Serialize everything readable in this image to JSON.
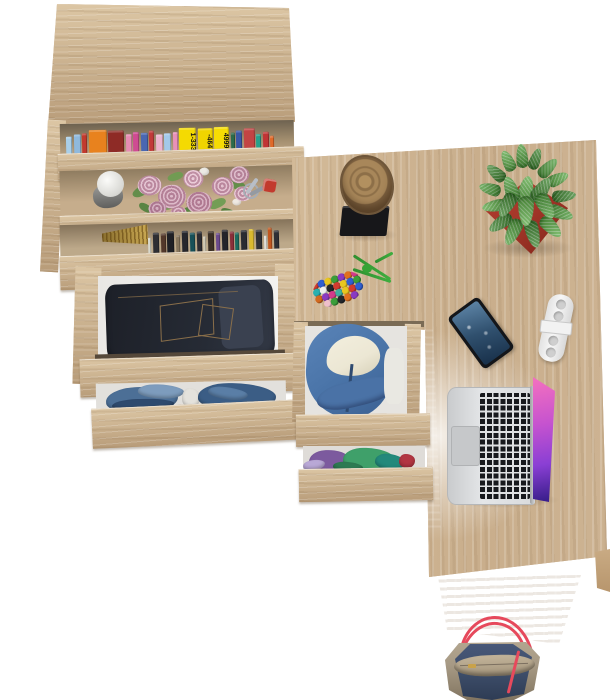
{
  "scene": {
    "type": "furniture-product-photo",
    "subject": "L-shaped oak desk with bookcase, open drawers and desk accessories, top view on white background",
    "background": "white"
  },
  "palette": {
    "bg": "#ffffff",
    "oak": "#cdb394",
    "oak_light": "#dcc6a4",
    "oak_dark": "#b89c79",
    "oak_panel": "#cfb28b",
    "shelf_shadow": "#6e6250",
    "jeans": "#262b35",
    "jeans_dark": "#1d2028",
    "jeans_stitch": "#8a6f4a",
    "hoodie": "#4a74a8",
    "hoodie_lining": "#ece7d4",
    "log": "#a8875a",
    "log_dark": "#6e563a",
    "base_black": "#17171a",
    "pot": "#a5372a",
    "plant": "#4f9e3c",
    "cord": "#3fae3f",
    "phone": "#14161a",
    "phone_screen": "#30506e",
    "gadget": "#f7f7f7",
    "laptop_silver": "#d9dbdd",
    "key_black": "#17191d",
    "bag_taupe": "#a79a85",
    "bag_navy": "#3d4d69",
    "bag_red": "#e6495c"
  },
  "objects": [
    {
      "name": "bookcase",
      "desc": "tall oak bookcase, two shelves of books, decor shelf, two open drawers"
    },
    {
      "name": "desk",
      "desc": "oak desk surface with log decor, succulent plant, keychain, phone, white gadget, laptop"
    },
    {
      "name": "pedestal",
      "desc": "under-desk drawer unit with blue hoodie and folded clothes"
    },
    {
      "name": "bag",
      "desc": "navy and taupe tote bag with red handles below desk"
    }
  ],
  "bookshelf": {
    "top_books": [
      {
        "c": "#a9cfe9",
        "w": 6,
        "h": 22
      },
      {
        "c": "#8fb9dd",
        "w": 7,
        "h": 24
      },
      {
        "c": "#c23a2e",
        "w": 5,
        "h": 25
      },
      {
        "c": "#e8821e",
        "w": 18,
        "h": 28
      },
      {
        "c": "#8e2b26",
        "w": 16,
        "h": 27
      },
      {
        "c": "#e78cb4",
        "w": 6,
        "h": 23
      },
      {
        "c": "#cf4b92",
        "w": 6,
        "h": 25
      },
      {
        "c": "#4a67b1",
        "w": 7,
        "h": 24
      },
      {
        "c": "#c23a3a",
        "w": 5,
        "h": 26
      },
      {
        "c": "#edb5cf",
        "w": 7,
        "h": 22
      },
      {
        "c": "#a3c9e9",
        "w": 7,
        "h": 23
      },
      {
        "c": "#e891b9",
        "w": 5,
        "h": 24
      },
      {
        "c": "#f4da02",
        "w": 17,
        "h": 28,
        "label": "1-333"
      },
      {
        "c": "#f0d400",
        "w": 15,
        "h": 27,
        "label": "-464"
      },
      {
        "c": "#f6dc04",
        "w": 15,
        "h": 28,
        "label": "4999"
      },
      {
        "c": "#2c6b4b",
        "w": 4,
        "h": 22
      },
      {
        "c": "#3a57a5",
        "w": 6,
        "h": 24
      },
      {
        "c": "#c24444",
        "w": 11,
        "h": 26
      },
      {
        "c": "#27a08c",
        "w": 5,
        "h": 20
      },
      {
        "c": "#c03535",
        "w": 6,
        "h": 22
      },
      {
        "c": "#e06a2a",
        "w": 4,
        "h": 18
      }
    ],
    "dark_books": [
      {
        "c": "#d8d8cc",
        "w": 3,
        "h": 18
      },
      {
        "c": "#2e2e33",
        "w": 6,
        "h": 23
      },
      {
        "c": "#53382a",
        "w": 5,
        "h": 22
      },
      {
        "c": "#1f2025",
        "w": 7,
        "h": 24
      },
      {
        "c": "#86755c",
        "w": 4,
        "h": 20
      },
      {
        "c": "#26272d",
        "w": 6,
        "h": 24
      },
      {
        "c": "#175058",
        "w": 5,
        "h": 22
      },
      {
        "c": "#2d2d33",
        "w": 5,
        "h": 23
      },
      {
        "c": "#d0c9b4",
        "w": 3,
        "h": 18
      },
      {
        "c": "#3b2f25",
        "w": 6,
        "h": 23
      },
      {
        "c": "#6b4a8c",
        "w": 4,
        "h": 21
      },
      {
        "c": "#23242a",
        "w": 6,
        "h": 24
      },
      {
        "c": "#8a2f3a",
        "w": 4,
        "h": 22
      },
      {
        "c": "#1c6b60",
        "w": 4,
        "h": 21
      },
      {
        "c": "#2a2b31",
        "w": 6,
        "h": 23
      },
      {
        "c": "#d9b92f",
        "w": 5,
        "h": 24
      },
      {
        "c": "#2f3036",
        "w": 6,
        "h": 23
      },
      {
        "c": "#e0dfda",
        "w": 3,
        "h": 17
      },
      {
        "c": "#c2571f",
        "w": 4,
        "h": 25
      },
      {
        "c": "#2e2f35",
        "w": 5,
        "h": 22
      }
    ],
    "bouquet": [
      {
        "cls": "leaf",
        "x": 8,
        "y": 18,
        "w": 20,
        "h": 10,
        "c": "#5f8c48",
        "r": -20
      },
      {
        "cls": "leaf",
        "x": 30,
        "y": 34,
        "w": 18,
        "h": 9,
        "c": "#6f9c52",
        "r": 15
      },
      {
        "cls": "leaf",
        "x": 58,
        "y": 40,
        "w": 20,
        "h": 10,
        "c": "#54823f",
        "r": 5
      },
      {
        "cls": "leaf",
        "x": 84,
        "y": 34,
        "w": 18,
        "h": 9,
        "c": "#6f9c52",
        "r": -15
      },
      {
        "cls": "leaf",
        "x": 104,
        "y": 16,
        "w": 18,
        "h": 9,
        "c": "#5f8c48",
        "r": 25
      },
      {
        "cls": "leaf",
        "x": 44,
        "y": 6,
        "w": 16,
        "h": 8,
        "c": "#6f9c52",
        "r": -10
      },
      {
        "cls": "leaf",
        "x": 96,
        "y": 44,
        "w": 16,
        "h": 8,
        "c": "#4f7c3b",
        "r": 30
      },
      {
        "cls": "leaf",
        "x": 14,
        "y": 36,
        "w": 14,
        "h": 8,
        "c": "#54823f",
        "r": 40
      },
      {
        "cls": "bud",
        "x": 76,
        "y": 2,
        "w": 10,
        "h": 8,
        "c": "#eceae4"
      },
      {
        "cls": "bud",
        "x": 108,
        "y": 34,
        "w": 9,
        "h": 7,
        "c": "#efe9e2"
      },
      {
        "cls": "bud",
        "x": 36,
        "y": 46,
        "w": 9,
        "h": 7,
        "c": "#e8e2d8"
      },
      {
        "cls": "rose",
        "x": 14,
        "y": 8,
        "w": 24,
        "h": 20,
        "c": "#d9aabe"
      },
      {
        "cls": "rose",
        "x": 34,
        "y": 18,
        "w": 28,
        "h": 24,
        "c": "#cf9cb2"
      },
      {
        "cls": "rose",
        "x": 60,
        "y": 4,
        "w": 20,
        "h": 18,
        "c": "#e2b6c8"
      },
      {
        "cls": "rose",
        "x": 62,
        "y": 26,
        "w": 26,
        "h": 22,
        "c": "#c993ab"
      },
      {
        "cls": "rose",
        "x": 88,
        "y": 12,
        "w": 22,
        "h": 19,
        "c": "#d9a8bc"
      },
      {
        "cls": "rose",
        "x": 106,
        "y": 2,
        "w": 20,
        "h": 17,
        "c": "#cf9fb4"
      },
      {
        "cls": "rose",
        "x": 110,
        "y": 22,
        "w": 18,
        "h": 15,
        "c": "#dcaec0"
      },
      {
        "cls": "rose",
        "x": 24,
        "y": 34,
        "w": 18,
        "h": 15,
        "c": "#c28da6"
      },
      {
        "cls": "rose",
        "x": 46,
        "y": 40,
        "w": 16,
        "h": 13,
        "c": "#d4a2b6"
      }
    ],
    "drawer_clothes": [
      {
        "cls": "cloth",
        "x": 10,
        "y": 4,
        "w": 72,
        "h": 26,
        "c": "#4c6f96",
        "r": -2
      },
      {
        "cls": "cloth",
        "x": 16,
        "y": 16,
        "w": 62,
        "h": 12,
        "c": "#2e4a6e",
        "r": -1
      },
      {
        "cls": "cloth",
        "x": 42,
        "y": 2,
        "w": 46,
        "h": 14,
        "c": "#7d9cbd",
        "r": 3
      },
      {
        "cls": "cloth",
        "x": 86,
        "y": 6,
        "w": 18,
        "h": 20,
        "c": "#e4e2dc",
        "r": 0
      },
      {
        "cls": "cloth",
        "x": 102,
        "y": 2,
        "w": 78,
        "h": 28,
        "c": "#3b5d85",
        "r": 2
      },
      {
        "cls": "cloth",
        "x": 112,
        "y": 6,
        "w": 40,
        "h": 12,
        "c": "#5a7ea6",
        "r": 8
      }
    ]
  },
  "desk": {
    "plant_leaves": [
      {
        "cls": "plant-leaf",
        "x": 38,
        "y": 2,
        "w": 12,
        "h": 24,
        "c": "#4f9e3c",
        "r": -5
      },
      {
        "cls": "plant-leaf",
        "x": 52,
        "y": 6,
        "w": 11,
        "h": 22,
        "c": "#3f8630",
        "r": 20
      },
      {
        "cls": "plant-leaf",
        "x": 24,
        "y": 8,
        "w": 12,
        "h": 22,
        "c": "#5cab46",
        "r": -25
      },
      {
        "cls": "plant-leaf",
        "x": 64,
        "y": 14,
        "w": 12,
        "h": 24,
        "c": "#4f9e3c",
        "r": 45
      },
      {
        "cls": "plant-leaf",
        "x": 12,
        "y": 20,
        "w": 12,
        "h": 22,
        "c": "#3f8630",
        "r": -50
      },
      {
        "cls": "plant-leaf",
        "x": 74,
        "y": 26,
        "w": 12,
        "h": 22,
        "c": "#5cab46",
        "r": 65
      },
      {
        "cls": "plant-leaf",
        "x": 6,
        "y": 36,
        "w": 12,
        "h": 22,
        "c": "#4f9e3c",
        "r": -75
      },
      {
        "cls": "plant-leaf",
        "x": 80,
        "y": 42,
        "w": 12,
        "h": 24,
        "c": "#3f8630",
        "r": 85
      },
      {
        "cls": "plant-leaf",
        "x": 10,
        "y": 52,
        "w": 12,
        "h": 24,
        "c": "#5cab46",
        "r": -100
      },
      {
        "cls": "plant-leaf",
        "x": 76,
        "y": 58,
        "w": 13,
        "h": 26,
        "c": "#4f9e3c",
        "r": 110
      },
      {
        "cls": "plant-leaf",
        "x": 16,
        "y": 68,
        "w": 13,
        "h": 26,
        "c": "#3f8630",
        "r": -125
      },
      {
        "cls": "plant-leaf",
        "x": 66,
        "y": 72,
        "w": 14,
        "h": 26,
        "c": "#5cab46",
        "r": 135
      },
      {
        "cls": "plant-leaf",
        "x": 28,
        "y": 76,
        "w": 14,
        "h": 28,
        "c": "#4f9e3c",
        "r": -155
      },
      {
        "cls": "plant-leaf",
        "x": 48,
        "y": 78,
        "w": 14,
        "h": 28,
        "c": "#3f8630",
        "r": 165
      },
      {
        "cls": "plant-leaf",
        "x": 40,
        "y": 34,
        "w": 16,
        "h": 30,
        "c": "#5cab46",
        "r": 10
      },
      {
        "cls": "plant-leaf",
        "x": 26,
        "y": 34,
        "w": 14,
        "h": 26,
        "c": "#4f9e3c",
        "r": -20
      },
      {
        "cls": "plant-leaf",
        "x": 56,
        "y": 34,
        "w": 15,
        "h": 28,
        "c": "#3f8630",
        "r": 35
      },
      {
        "cls": "plant-leaf",
        "x": 40,
        "y": 54,
        "w": 16,
        "h": 30,
        "c": "#5cab46",
        "r": 180
      },
      {
        "cls": "plant-leaf",
        "x": 22,
        "y": 50,
        "w": 14,
        "h": 26,
        "c": "#3f8630",
        "r": -150
      },
      {
        "cls": "plant-leaf",
        "x": 60,
        "y": 50,
        "w": 15,
        "h": 28,
        "c": "#4f9e3c",
        "r": 150
      }
    ],
    "bead_colors": [
      "#d23b2f",
      "#2f5fd2",
      "#e8c61f",
      "#3a9e3a",
      "#8a3ac2",
      "#e0701f",
      "#d23b8a",
      "#29b0b0",
      "#efefef",
      "#23262b",
      "#d23b2f",
      "#e8c61f",
      "#2f5fd2",
      "#3a9e3a",
      "#d2691f",
      "#8a3ac2",
      "#d23b8a",
      "#3fae9e",
      "#e8c61f",
      "#d23b2f",
      "#2f5fd2",
      "#efc0cb",
      "#3a9e3a",
      "#23262b",
      "#e0701f",
      "#8a3ac2"
    ]
  },
  "pedestal": {
    "drawer_clothes": [
      {
        "cls": "cloth",
        "x": 6,
        "y": 4,
        "w": 40,
        "h": 22,
        "c": "#7c5a9e",
        "r": -3
      },
      {
        "cls": "cloth",
        "x": 40,
        "y": 2,
        "w": 52,
        "h": 24,
        "c": "#3fa06a",
        "r": 2
      },
      {
        "cls": "cloth",
        "x": 72,
        "y": 8,
        "w": 30,
        "h": 16,
        "c": "#23897b",
        "r": 6
      },
      {
        "cls": "cloth",
        "x": 96,
        "y": 8,
        "w": 16,
        "h": 14,
        "c": "#b23642",
        "r": 0
      },
      {
        "cls": "cloth",
        "x": 0,
        "y": 14,
        "w": 22,
        "h": 10,
        "c": "#b9a8d6",
        "r": -8
      },
      {
        "cls": "cloth",
        "x": 30,
        "y": 16,
        "w": 30,
        "h": 10,
        "c": "#2d7a52",
        "r": 4
      }
    ]
  }
}
